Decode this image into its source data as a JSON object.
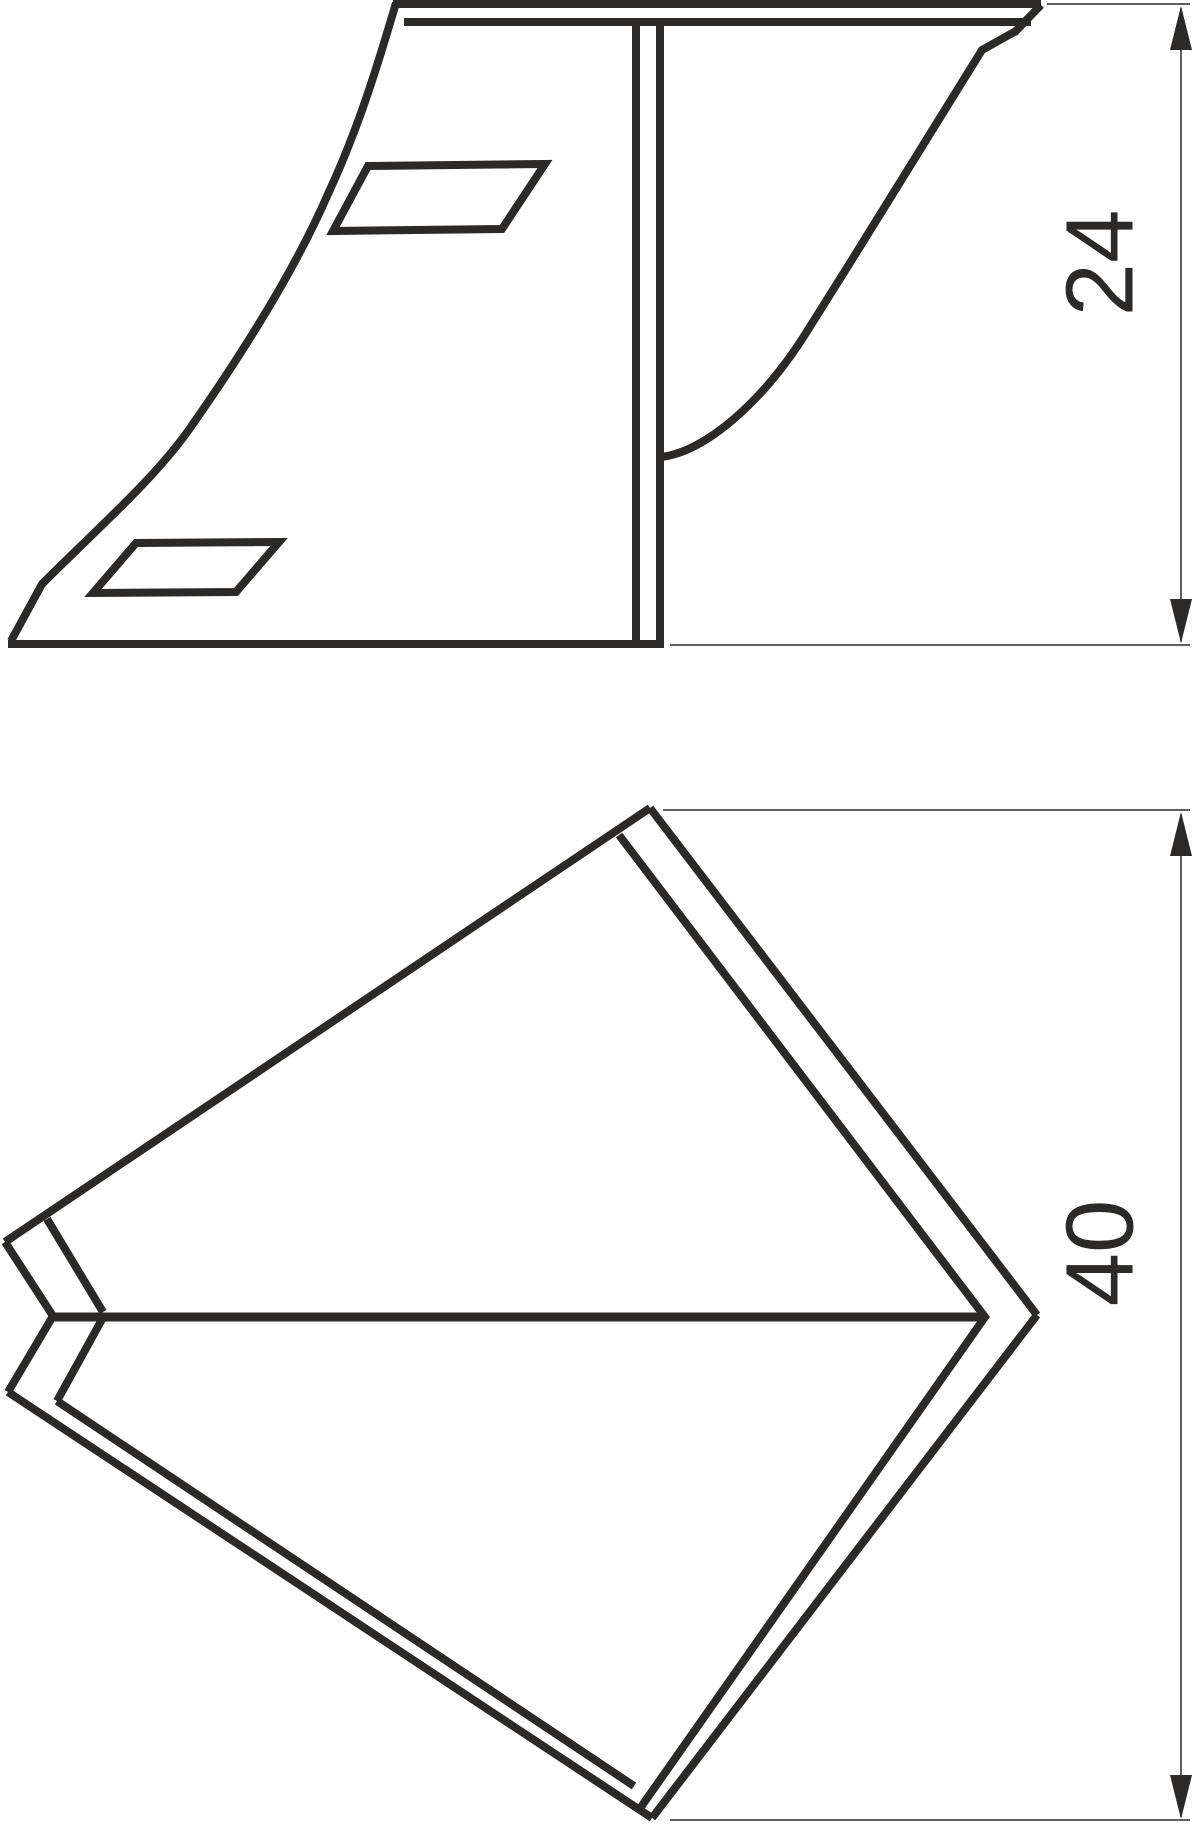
{
  "drawing": {
    "background_color": "#fefefe",
    "line_color": "#2b2a29",
    "type": "technical-drawing",
    "views": [
      {
        "id": "side-view",
        "description": "side elevation with two parallelogram slots"
      },
      {
        "id": "plan-view",
        "description": "kite shaped plan view with center crease"
      }
    ],
    "dimensions": [
      {
        "id": "dim-side-height",
        "label": "24",
        "orientation": "vertical"
      },
      {
        "id": "dim-plan-height",
        "label": "40",
        "orientation": "vertical"
      }
    ]
  }
}
